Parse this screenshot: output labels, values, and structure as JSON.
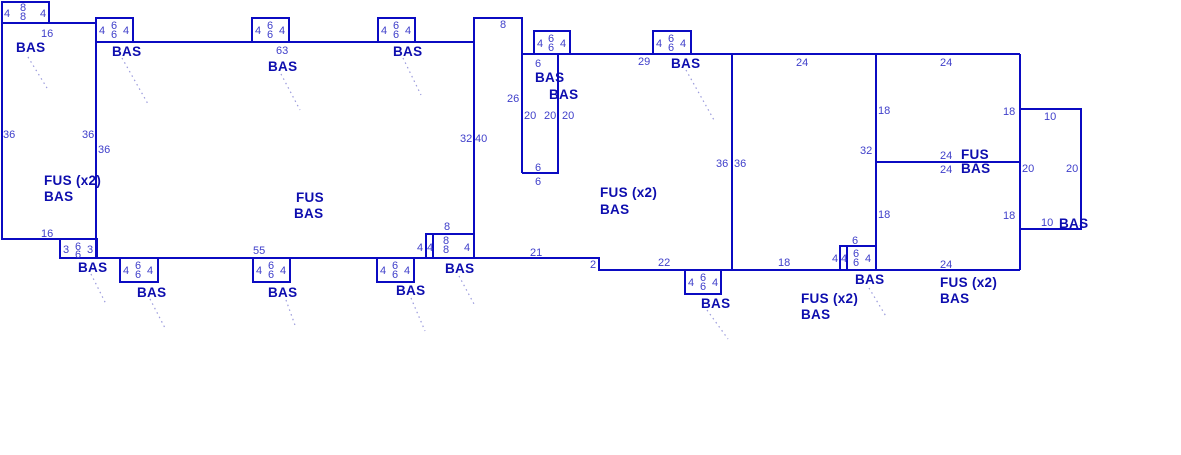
{
  "sketch": {
    "colors": {
      "wall": "#0b0bc2",
      "dim": "#3f3fca",
      "area": "#0d0dae",
      "leader": "#9a9adc",
      "background": "#ffffff"
    },
    "dim_labels": [
      {
        "t": "4",
        "x": 4,
        "y": 17
      },
      {
        "t": "8",
        "x": 20,
        "y": 11
      },
      {
        "t": "8",
        "x": 20,
        "y": 20
      },
      {
        "t": "4",
        "x": 40,
        "y": 17
      },
      {
        "t": "16",
        "x": 41,
        "y": 37
      },
      {
        "t": "36",
        "x": 3,
        "y": 138
      },
      {
        "t": "36",
        "x": 82,
        "y": 138
      },
      {
        "t": "36",
        "x": 98,
        "y": 153
      },
      {
        "t": "16",
        "x": 41,
        "y": 237
      },
      {
        "t": "3",
        "x": 63,
        "y": 253
      },
      {
        "t": "6",
        "x": 75,
        "y": 250
      },
      {
        "t": "6",
        "x": 75,
        "y": 258
      },
      {
        "t": "3",
        "x": 87,
        "y": 253
      },
      {
        "t": "4",
        "x": 99,
        "y": 34
      },
      {
        "t": "6",
        "x": 111,
        "y": 29
      },
      {
        "t": "6",
        "x": 111,
        "y": 38
      },
      {
        "t": "4",
        "x": 123,
        "y": 34
      },
      {
        "t": "4",
        "x": 255,
        "y": 34
      },
      {
        "t": "6",
        "x": 267,
        "y": 29
      },
      {
        "t": "6",
        "x": 267,
        "y": 38
      },
      {
        "t": "4",
        "x": 279,
        "y": 34
      },
      {
        "t": "63",
        "x": 276,
        "y": 54
      },
      {
        "t": "4",
        "x": 381,
        "y": 34
      },
      {
        "t": "6",
        "x": 393,
        "y": 29
      },
      {
        "t": "6",
        "x": 393,
        "y": 38
      },
      {
        "t": "4",
        "x": 405,
        "y": 34
      },
      {
        "t": "4",
        "x": 537,
        "y": 47
      },
      {
        "t": "6",
        "x": 548,
        "y": 42
      },
      {
        "t": "6",
        "x": 548,
        "y": 51
      },
      {
        "t": "4",
        "x": 560,
        "y": 47
      },
      {
        "t": "4",
        "x": 656,
        "y": 47
      },
      {
        "t": "6",
        "x": 668,
        "y": 42
      },
      {
        "t": "6",
        "x": 668,
        "y": 51
      },
      {
        "t": "4",
        "x": 680,
        "y": 47
      },
      {
        "t": "29",
        "x": 638,
        "y": 65
      },
      {
        "t": "8",
        "x": 500,
        "y": 28
      },
      {
        "t": "26",
        "x": 507,
        "y": 102
      },
      {
        "t": "32",
        "x": 460,
        "y": 142
      },
      {
        "t": "40",
        "x": 475,
        "y": 142
      },
      {
        "t": "6",
        "x": 535,
        "y": 67
      },
      {
        "t": "20",
        "x": 524,
        "y": 119
      },
      {
        "t": "20",
        "x": 544,
        "y": 119
      },
      {
        "t": "20",
        "x": 562,
        "y": 119
      },
      {
        "t": "6",
        "x": 535,
        "y": 171
      },
      {
        "t": "6",
        "x": 535,
        "y": 185
      },
      {
        "t": "55",
        "x": 253,
        "y": 254
      },
      {
        "t": "21",
        "x": 530,
        "y": 256
      },
      {
        "t": "2",
        "x": 590,
        "y": 268
      },
      {
        "t": "22",
        "x": 658,
        "y": 266
      },
      {
        "t": "18",
        "x": 778,
        "y": 266
      },
      {
        "t": "8",
        "x": 444,
        "y": 230
      },
      {
        "t": "4",
        "x": 417,
        "y": 251
      },
      {
        "t": "4",
        "x": 427,
        "y": 251
      },
      {
        "t": "8",
        "x": 443,
        "y": 244
      },
      {
        "t": "8",
        "x": 443,
        "y": 253
      },
      {
        "t": "4",
        "x": 464,
        "y": 251
      },
      {
        "t": "4",
        "x": 123,
        "y": 274
      },
      {
        "t": "6",
        "x": 135,
        "y": 269
      },
      {
        "t": "6",
        "x": 135,
        "y": 278
      },
      {
        "t": "4",
        "x": 147,
        "y": 274
      },
      {
        "t": "4",
        "x": 256,
        "y": 274
      },
      {
        "t": "6",
        "x": 268,
        "y": 269
      },
      {
        "t": "6",
        "x": 268,
        "y": 278
      },
      {
        "t": "4",
        "x": 280,
        "y": 274
      },
      {
        "t": "4",
        "x": 380,
        "y": 274
      },
      {
        "t": "6",
        "x": 392,
        "y": 269
      },
      {
        "t": "6",
        "x": 392,
        "y": 278
      },
      {
        "t": "4",
        "x": 404,
        "y": 274
      },
      {
        "t": "4",
        "x": 688,
        "y": 286
      },
      {
        "t": "6",
        "x": 700,
        "y": 281
      },
      {
        "t": "6",
        "x": 700,
        "y": 290
      },
      {
        "t": "4",
        "x": 712,
        "y": 286
      },
      {
        "t": "6",
        "x": 852,
        "y": 244
      },
      {
        "t": "4",
        "x": 832,
        "y": 262
      },
      {
        "t": "4",
        "x": 841,
        "y": 262
      },
      {
        "t": "6",
        "x": 853,
        "y": 257
      },
      {
        "t": "6",
        "x": 853,
        "y": 266
      },
      {
        "t": "4",
        "x": 865,
        "y": 262
      },
      {
        "t": "24",
        "x": 796,
        "y": 66
      },
      {
        "t": "24",
        "x": 940,
        "y": 66
      },
      {
        "t": "36",
        "x": 716,
        "y": 167
      },
      {
        "t": "36",
        "x": 734,
        "y": 167
      },
      {
        "t": "18",
        "x": 878,
        "y": 114
      },
      {
        "t": "32",
        "x": 860,
        "y": 154
      },
      {
        "t": "18",
        "x": 878,
        "y": 218
      },
      {
        "t": "18",
        "x": 1003,
        "y": 115
      },
      {
        "t": "18",
        "x": 1003,
        "y": 219
      },
      {
        "t": "24",
        "x": 940,
        "y": 159
      },
      {
        "t": "24",
        "x": 940,
        "y": 173
      },
      {
        "t": "10",
        "x": 1044,
        "y": 120
      },
      {
        "t": "20",
        "x": 1022,
        "y": 172
      },
      {
        "t": "20",
        "x": 1066,
        "y": 172
      },
      {
        "t": "10",
        "x": 1041,
        "y": 226
      },
      {
        "t": "24",
        "x": 940,
        "y": 268
      }
    ],
    "area_labels": [
      {
        "t": "BAS",
        "x": 16,
        "y": 52
      },
      {
        "t": "BAS",
        "x": 112,
        "y": 56
      },
      {
        "t": "BAS",
        "x": 268,
        "y": 71
      },
      {
        "t": "BAS",
        "x": 393,
        "y": 56
      },
      {
        "t": "BAS",
        "x": 535,
        "y": 82
      },
      {
        "t": "BAS",
        "x": 549,
        "y": 99
      },
      {
        "t": "BAS",
        "x": 671,
        "y": 68
      },
      {
        "t": "FUS (x2)",
        "x": 44,
        "y": 185
      },
      {
        "t": "BAS",
        "x": 44,
        "y": 201
      },
      {
        "t": "FUS",
        "x": 296,
        "y": 202
      },
      {
        "t": "BAS",
        "x": 294,
        "y": 218
      },
      {
        "t": "FUS (x2)",
        "x": 600,
        "y": 197
      },
      {
        "t": "BAS",
        "x": 600,
        "y": 214
      },
      {
        "t": "BAS",
        "x": 78,
        "y": 272
      },
      {
        "t": "BAS",
        "x": 137,
        "y": 297
      },
      {
        "t": "BAS",
        "x": 268,
        "y": 297
      },
      {
        "t": "BAS",
        "x": 396,
        "y": 295
      },
      {
        "t": "BAS",
        "x": 445,
        "y": 273
      },
      {
        "t": "BAS",
        "x": 701,
        "y": 308
      },
      {
        "t": "FUS (x2)",
        "x": 801,
        "y": 303
      },
      {
        "t": "BAS",
        "x": 801,
        "y": 319
      },
      {
        "t": "BAS",
        "x": 855,
        "y": 284
      },
      {
        "t": "FUS",
        "x": 961,
        "y": 159
      },
      {
        "t": "BAS",
        "x": 961,
        "y": 173
      },
      {
        "t": "FUS (x2)",
        "x": 940,
        "y": 287
      },
      {
        "t": "BAS",
        "x": 940,
        "y": 303
      },
      {
        "t": "BAS",
        "x": 1059,
        "y": 228
      }
    ],
    "leaders": [
      {
        "x1": 28,
        "y1": 57,
        "x2": 47,
        "y2": 88
      },
      {
        "x1": 122,
        "y1": 58,
        "x2": 148,
        "y2": 104
      },
      {
        "x1": 281,
        "y1": 74,
        "x2": 300,
        "y2": 110
      },
      {
        "x1": 403,
        "y1": 58,
        "x2": 421,
        "y2": 95
      },
      {
        "x1": 686,
        "y1": 70,
        "x2": 714,
        "y2": 120
      },
      {
        "x1": 91,
        "y1": 274,
        "x2": 106,
        "y2": 304
      },
      {
        "x1": 150,
        "y1": 299,
        "x2": 165,
        "y2": 328
      },
      {
        "x1": 286,
        "y1": 300,
        "x2": 296,
        "y2": 328
      },
      {
        "x1": 411,
        "y1": 298,
        "x2": 425,
        "y2": 331
      },
      {
        "x1": 459,
        "y1": 276,
        "x2": 474,
        "y2": 304
      },
      {
        "x1": 707,
        "y1": 310,
        "x2": 728,
        "y2": 339
      },
      {
        "x1": 869,
        "y1": 288,
        "x2": 887,
        "y2": 318
      }
    ]
  }
}
